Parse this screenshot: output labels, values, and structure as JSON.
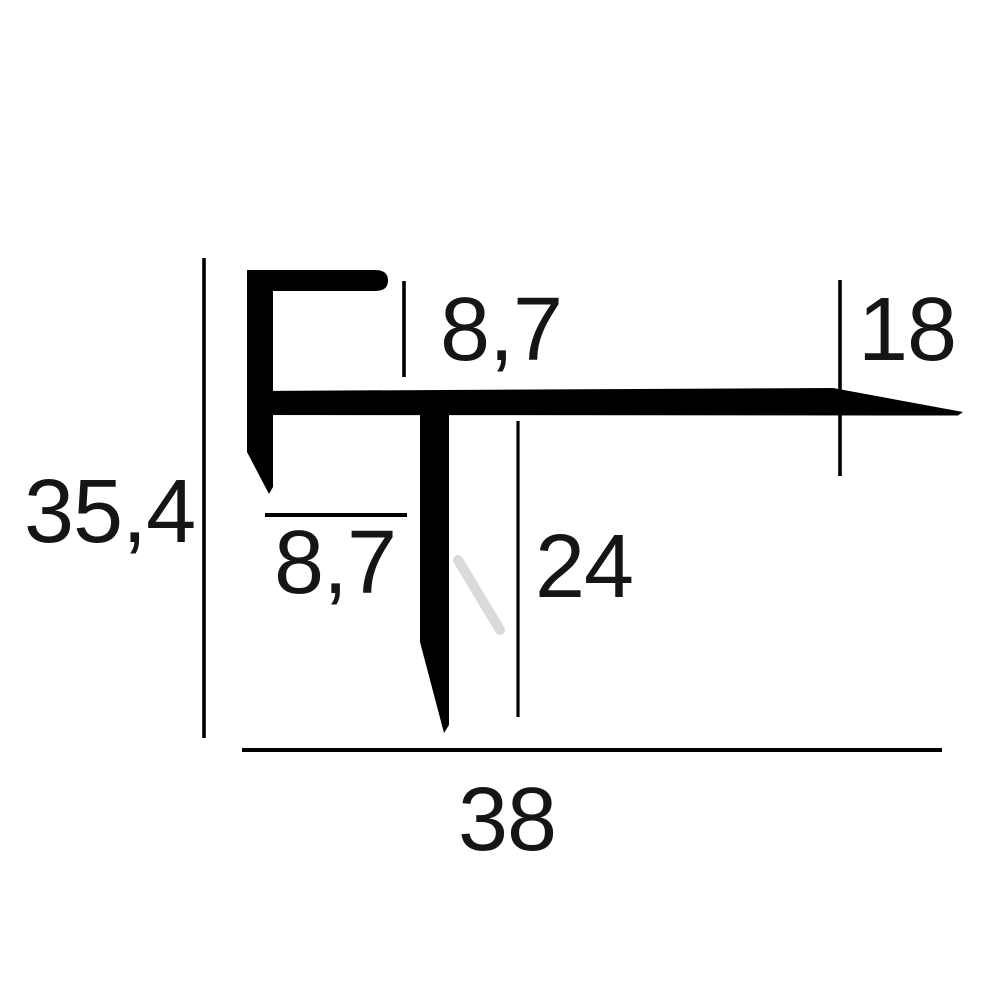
{
  "diagram": {
    "kind": "profile-cross-section-dimension-drawing",
    "background_color": "#ffffff",
    "ink_color": "#000000",
    "text_color": "#151515",
    "watermark_color": "#dadada",
    "dimensions": {
      "overall_height": "35,4",
      "top_return_depth": "8,7",
      "right_end_height": "18",
      "left_return_width": "8,7",
      "stem_height": "24",
      "overall_width": "38"
    }
  }
}
